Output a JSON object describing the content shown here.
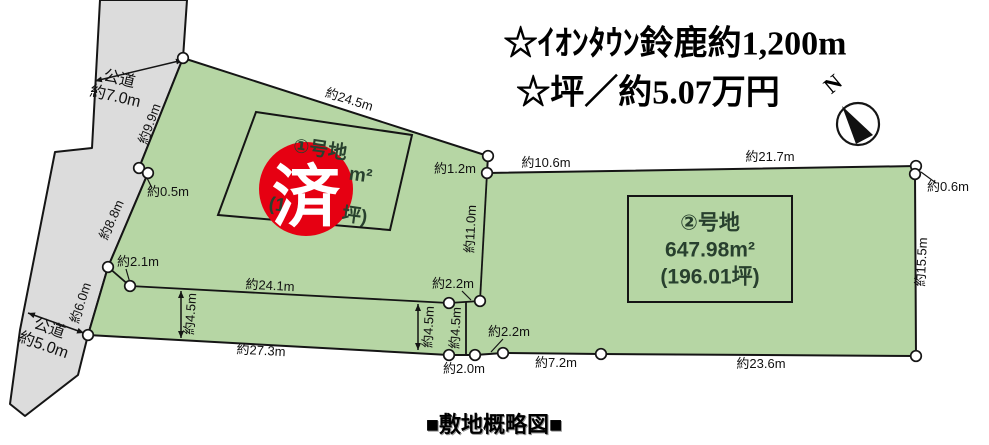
{
  "title": {
    "line1": "☆ｲｵﾝﾀｳﾝ鈴鹿約1,200m",
    "line2": "☆坪／約5.07万円"
  },
  "caption": "■敷地概略図■",
  "compass": {
    "label": "N"
  },
  "roads": {
    "north": {
      "label": "公道",
      "width": "約7.0m"
    },
    "west": {
      "label": "公道",
      "width": "約5.0m"
    }
  },
  "plots": {
    "plot1": {
      "stamp": "済",
      "line1": "①号地",
      "line2": "m²",
      "line3": "(1　　　坪)"
    },
    "plot2": {
      "line1": "②号地",
      "line2": "647.98m²",
      "line3": "(196.01坪)"
    }
  },
  "dimensions": {
    "plot1_top_edge": "約24.5m",
    "plot1_road_frontage_upper": "約9.9m",
    "road_jog": "約0.5m",
    "plot1_road_frontage_mid": "約8.8m",
    "frontage_jog": "約2.1m",
    "plot1_road_frontage_lower": "約6.0m",
    "strip_top_edge": "約24.1m",
    "strip_width_west": "約4.5m",
    "strip_bottom_edge": "約27.3m",
    "boundary_top_jog": "約1.2m",
    "boundary_line": "約11.0m",
    "boundary_bottom_jog": "約2.2m",
    "strip_width_east": "約4.5m",
    "boundary_south_segment": "約4.5m",
    "south_segment_small": "約2.0m",
    "south_segment_small2": "約2.2m",
    "plot2_bottom_west": "約7.2m",
    "plot2_bottom_east": "約23.6m",
    "plot2_top_west": "約10.6m",
    "plot2_top_east": "約21.7m",
    "plot2_ne_jog": "約0.6m",
    "plot2_east_edge": "約15.5m"
  },
  "colors": {
    "land_green": "#b6d6a4",
    "road_gray": "#dcdcdc",
    "stamp_red": "#e60012",
    "line": "#151515"
  }
}
